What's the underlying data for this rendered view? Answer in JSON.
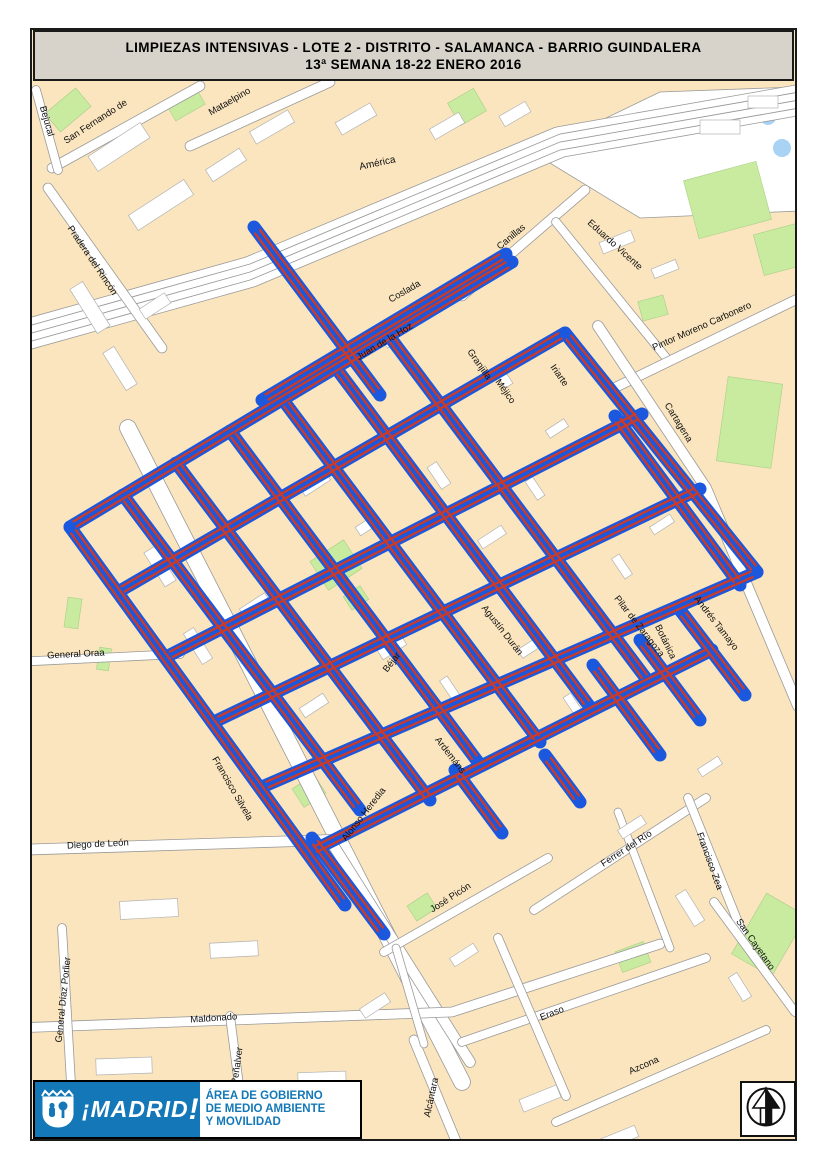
{
  "title": {
    "line1": "LIMPIEZAS  INTENSIVAS - LOTE 2 - DISTRITO - SALAMANCA - BARRIO GUINDALERA",
    "line2": "13ª SEMANA 18-22 ENERO 2016"
  },
  "footer": {
    "brand": "¡MADRID",
    "bang": "!",
    "dept1": "ÁREA DE GOBIERNO",
    "dept2": "DE MEDIO AMBIENTE",
    "dept3": "Y MOVILIDAD",
    "crest_icon": "madrid-bear-and-tree-crest",
    "north_icon": "north-arrow"
  },
  "colors": {
    "route_blue": "#1b58dd",
    "route_red": "#cc3a28",
    "block_peach": "#fae5be",
    "park_green": "#c8eba0",
    "water_blue": "#a9d3f5",
    "street_casing": "#9a9a9a",
    "street_fill": "#ffffff",
    "logo_blue": "#1478b8",
    "title_gray": "#d7d3cb"
  },
  "map": {
    "frame": {
      "x": 31,
      "y": 29,
      "w": 765,
      "h": 1111
    },
    "routes": [
      {
        "name": "coslada",
        "x1": 262,
        "y1": 400,
        "x2": 506,
        "y2": 254
      },
      {
        "name": "juan-de-la-hoz",
        "x1": 70,
        "y1": 527,
        "x2": 512,
        "y2": 262
      },
      {
        "name": "row-2",
        "x1": 118,
        "y1": 592,
        "x2": 565,
        "y2": 333
      },
      {
        "name": "row-3",
        "x1": 166,
        "y1": 657,
        "x2": 642,
        "y2": 414
      },
      {
        "name": "row-4",
        "x1": 214,
        "y1": 722,
        "x2": 700,
        "y2": 489
      },
      {
        "name": "agustin-duran",
        "x1": 262,
        "y1": 787,
        "x2": 757,
        "y2": 572
      },
      {
        "name": "ardemans-row",
        "x1": 310,
        "y1": 852,
        "x2": 712,
        "y2": 650
      },
      {
        "name": "arm-north",
        "x1": 254,
        "y1": 227,
        "x2": 380,
        "y2": 395
      },
      {
        "name": "francisco-silvela-route",
        "x1": 70,
        "y1": 527,
        "x2": 345,
        "y2": 905
      },
      {
        "name": "col-2",
        "x1": 123,
        "y1": 495,
        "x2": 360,
        "y2": 810
      },
      {
        "name": "col-3",
        "x1": 176,
        "y1": 463,
        "x2": 430,
        "y2": 800
      },
      {
        "name": "col-4",
        "x1": 230,
        "y1": 431,
        "x2": 478,
        "y2": 762
      },
      {
        "name": "col-5",
        "x1": 283,
        "y1": 400,
        "x2": 540,
        "y2": 742
      },
      {
        "name": "col-6",
        "x1": 336,
        "y1": 368,
        "x2": 590,
        "y2": 707
      },
      {
        "name": "col-7",
        "x1": 389,
        "y1": 336,
        "x2": 648,
        "y2": 681
      },
      {
        "name": "iriarte-route",
        "x1": 565,
        "y1": 333,
        "x2": 757,
        "y2": 572
      },
      {
        "name": "col-9",
        "x1": 615,
        "y1": 416,
        "x2": 740,
        "y2": 585
      },
      {
        "name": "alonso-heredia-stub",
        "x1": 312,
        "y1": 838,
        "x2": 384,
        "y2": 934
      },
      {
        "name": "stub-south-1",
        "x1": 455,
        "y1": 770,
        "x2": 502,
        "y2": 833
      },
      {
        "name": "stub-south-2",
        "x1": 545,
        "y1": 755,
        "x2": 580,
        "y2": 802
      },
      {
        "name": "pilar-de-zaragoza-stub",
        "x1": 593,
        "y1": 665,
        "x2": 660,
        "y2": 755
      },
      {
        "name": "botanica-stub",
        "x1": 640,
        "y1": 640,
        "x2": 700,
        "y2": 720
      },
      {
        "name": "andres-tamayo-stub",
        "x1": 680,
        "y1": 610,
        "x2": 745,
        "y2": 695
      }
    ],
    "streets": [
      {
        "name": "america",
        "w": 30,
        "pts": [
          [
            14,
            338
          ],
          [
            250,
            272
          ],
          [
            560,
            142
          ],
          [
            822,
            96
          ]
        ]
      },
      {
        "name": "america-lane-a",
        "thin": true,
        "pts": [
          [
            14,
            346
          ],
          [
            250,
            280
          ],
          [
            560,
            150
          ],
          [
            822,
            104
          ]
        ]
      },
      {
        "name": "america-lane-b",
        "thin": true,
        "pts": [
          [
            14,
            330
          ],
          [
            250,
            264
          ],
          [
            560,
            134
          ],
          [
            822,
            88
          ]
        ]
      },
      {
        "name": "america-lane-c",
        "thin": true,
        "pts": [
          [
            14,
            338
          ],
          [
            250,
            272
          ],
          [
            560,
            142
          ],
          [
            822,
            96
          ]
        ]
      },
      {
        "name": "san-fernando",
        "w": 9,
        "pts": [
          [
            52,
            168
          ],
          [
            200,
            86
          ]
        ]
      },
      {
        "name": "mataelpino",
        "w": 9,
        "pts": [
          [
            190,
            146
          ],
          [
            330,
            82
          ]
        ]
      },
      {
        "name": "bejucal",
        "w": 8,
        "pts": [
          [
            36,
            90
          ],
          [
            58,
            170
          ]
        ]
      },
      {
        "name": "pradera-del-rincon",
        "w": 9,
        "pts": [
          [
            48,
            188
          ],
          [
            162,
            348
          ]
        ]
      },
      {
        "name": "canillas",
        "w": 9,
        "pts": [
          [
            462,
            296
          ],
          [
            585,
            190
          ]
        ]
      },
      {
        "name": "eduardo-vicente",
        "w": 8,
        "pts": [
          [
            556,
            222
          ],
          [
            668,
            360
          ]
        ]
      },
      {
        "name": "pintor-moreno-carbonero",
        "w": 9,
        "pts": [
          [
            610,
            390
          ],
          [
            820,
            288
          ]
        ]
      },
      {
        "name": "cartagena",
        "w": 10,
        "pts": [
          [
            598,
            326
          ],
          [
            706,
            488
          ],
          [
            798,
            706
          ]
        ]
      },
      {
        "name": "francisco-silvela",
        "w": 16,
        "pts": [
          [
            128,
            428
          ],
          [
            462,
            1082
          ]
        ]
      },
      {
        "name": "diego-de-leon",
        "w": 10,
        "pts": [
          [
            14,
            850
          ],
          [
            330,
            840
          ],
          [
            470,
            1062
          ]
        ]
      },
      {
        "name": "general-oraa",
        "w": 8,
        "pts": [
          [
            14,
            662
          ],
          [
            180,
            654
          ]
        ]
      },
      {
        "name": "maldonado",
        "w": 9,
        "pts": [
          [
            14,
            1028
          ],
          [
            452,
            1012
          ],
          [
            660,
            944
          ]
        ]
      },
      {
        "name": "general-diaz-porlier",
        "w": 8,
        "pts": [
          [
            62,
            928
          ],
          [
            76,
            1170
          ]
        ]
      },
      {
        "name": "penalver",
        "w": 8,
        "pts": [
          [
            230,
            1016
          ],
          [
            250,
            1170
          ]
        ]
      },
      {
        "name": "alcantara",
        "w": 9,
        "pts": [
          [
            414,
            1040
          ],
          [
            468,
            1170
          ]
        ]
      },
      {
        "name": "jose-picon",
        "w": 8,
        "pts": [
          [
            384,
            952
          ],
          [
            548,
            858
          ]
        ]
      },
      {
        "name": "ferrer-del-rio",
        "w": 8,
        "pts": [
          [
            534,
            910
          ],
          [
            706,
            798
          ]
        ]
      },
      {
        "name": "francisco-zea",
        "w": 8,
        "pts": [
          [
            688,
            798
          ],
          [
            742,
            932
          ]
        ]
      },
      {
        "name": "san-cayetano",
        "w": 8,
        "pts": [
          [
            714,
            902
          ],
          [
            795,
            1012
          ]
        ]
      },
      {
        "name": "eraso",
        "w": 8,
        "pts": [
          [
            462,
            1042
          ],
          [
            706,
            958
          ]
        ]
      },
      {
        "name": "azcona",
        "w": 8,
        "pts": [
          [
            556,
            1122
          ],
          [
            766,
            1030
          ]
        ]
      },
      {
        "name": "side-street-1",
        "w": 8,
        "pts": [
          [
            498,
            938
          ],
          [
            566,
            1096
          ]
        ]
      },
      {
        "name": "side-street-2",
        "w": 7,
        "pts": [
          [
            618,
            812
          ],
          [
            670,
            948
          ]
        ]
      },
      {
        "name": "side-street-3",
        "w": 7,
        "pts": [
          [
            396,
            948
          ],
          [
            424,
            1044
          ]
        ]
      }
    ],
    "labels": [
      {
        "t": "América",
        "x": 378,
        "y": 166,
        "r": -12,
        "f": 10
      },
      {
        "t": "San Fernando de",
        "x": 97,
        "y": 124,
        "r": -33
      },
      {
        "t": "Mataelpino",
        "x": 231,
        "y": 104,
        "r": -30
      },
      {
        "t": "Bejucal",
        "x": 44,
        "y": 122,
        "r": 74
      },
      {
        "t": "Pradera del Rincón",
        "x": 90,
        "y": 262,
        "r": 56
      },
      {
        "t": "Canillas",
        "x": 513,
        "y": 239,
        "r": -40
      },
      {
        "t": "Eduardo Vicente",
        "x": 613,
        "y": 247,
        "r": 42
      },
      {
        "t": "Pintor Moreno Carbonero",
        "x": 703,
        "y": 329,
        "r": -24
      },
      {
        "t": "Cartagena",
        "x": 676,
        "y": 424,
        "r": 58
      },
      {
        "t": "Coslada",
        "x": 406,
        "y": 294,
        "r": -30
      },
      {
        "t": "Juan de la Hoz",
        "x": 386,
        "y": 344,
        "r": -31
      },
      {
        "t": "Granjilla",
        "x": 477,
        "y": 366,
        "r": 55
      },
      {
        "t": "Méjico",
        "x": 503,
        "y": 393,
        "r": 55
      },
      {
        "t": "Iriarte",
        "x": 557,
        "y": 377,
        "r": 55
      },
      {
        "t": "Agustín Durán",
        "x": 500,
        "y": 632,
        "r": 52
      },
      {
        "t": "Béjar",
        "x": 394,
        "y": 664,
        "r": -52
      },
      {
        "t": "Ardemáns",
        "x": 448,
        "y": 757,
        "r": 52
      },
      {
        "t": "Alonso Heredia",
        "x": 366,
        "y": 816,
        "r": -52
      },
      {
        "t": "Pilar de Zaragoza",
        "x": 637,
        "y": 628,
        "r": 52
      },
      {
        "t": "Botánica",
        "x": 663,
        "y": 643,
        "r": 64
      },
      {
        "t": "Andrés Tamayo",
        "x": 714,
        "y": 625,
        "r": 52
      },
      {
        "t": "Francisco Silvela",
        "x": 230,
        "y": 790,
        "r": 60
      },
      {
        "t": "General Oraa",
        "x": 76,
        "y": 657,
        "r": -3
      },
      {
        "t": "Diego de León",
        "x": 98,
        "y": 847,
        "r": -3
      },
      {
        "t": "Maldonado",
        "x": 214,
        "y": 1021,
        "r": -4
      },
      {
        "t": "General Díaz Porlier",
        "x": 66,
        "y": 1000,
        "r": -84
      },
      {
        "t": "Peñalver",
        "x": 240,
        "y": 1066,
        "r": -82
      },
      {
        "t": "Alcántara",
        "x": 434,
        "y": 1098,
        "r": -78
      },
      {
        "t": "José Picón",
        "x": 452,
        "y": 900,
        "r": -33
      },
      {
        "t": "Ferrer del Río",
        "x": 628,
        "y": 851,
        "r": -33
      },
      {
        "t": "Francisco Zea",
        "x": 707,
        "y": 862,
        "r": 70
      },
      {
        "t": "San Cayetano",
        "x": 753,
        "y": 946,
        "r": 55
      },
      {
        "t": "Eraso",
        "x": 553,
        "y": 1016,
        "r": -22
      },
      {
        "t": "Azcona",
        "x": 645,
        "y": 1068,
        "r": -24
      }
    ],
    "greens": [
      {
        "x": 690,
        "y": 170,
        "w": 75,
        "h": 60,
        "r": -15
      },
      {
        "x": 758,
        "y": 228,
        "w": 48,
        "h": 42,
        "r": -15
      },
      {
        "x": 722,
        "y": 380,
        "w": 55,
        "h": 85,
        "r": 8
      },
      {
        "x": 795,
        "y": 295,
        "w": 26,
        "h": 65,
        "r": 0
      },
      {
        "x": 640,
        "y": 298,
        "w": 26,
        "h": 20,
        "r": -15
      },
      {
        "x": 56,
        "y": 90,
        "w": 24,
        "h": 40,
        "r": 50
      },
      {
        "x": 168,
        "y": 92,
        "w": 34,
        "h": 22,
        "r": -30
      },
      {
        "x": 452,
        "y": 94,
        "w": 30,
        "h": 26,
        "r": -30
      },
      {
        "x": 316,
        "y": 548,
        "w": 40,
        "h": 34,
        "r": -33
      },
      {
        "x": 296,
        "y": 780,
        "w": 26,
        "h": 22,
        "r": -33
      },
      {
        "x": 746,
        "y": 900,
        "w": 46,
        "h": 70,
        "r": 30
      },
      {
        "x": 754,
        "y": 1082,
        "w": 48,
        "h": 36,
        "r": 0
      },
      {
        "x": 618,
        "y": 946,
        "w": 30,
        "h": 22,
        "r": -20
      },
      {
        "x": 66,
        "y": 598,
        "w": 14,
        "h": 30,
        "r": 8
      },
      {
        "x": 98,
        "y": 648,
        "w": 12,
        "h": 22,
        "r": 8
      },
      {
        "x": 346,
        "y": 590,
        "w": 20,
        "h": 16,
        "r": -33
      },
      {
        "x": 410,
        "y": 898,
        "w": 24,
        "h": 18,
        "r": -33
      }
    ],
    "water": [
      {
        "cx": 768,
        "cy": 117,
        "rr": 8
      },
      {
        "cx": 782,
        "cy": 148,
        "rr": 9
      }
    ],
    "buildings": [
      [
        88,
        138,
        62,
        18,
        -33
      ],
      [
        128,
        196,
        66,
        18,
        -33
      ],
      [
        206,
        158,
        40,
        14,
        -33
      ],
      [
        250,
        120,
        44,
        14,
        -30
      ],
      [
        336,
        112,
        40,
        14,
        -30
      ],
      [
        64,
        300,
        52,
        15,
        58
      ],
      [
        98,
        362,
        44,
        13,
        58
      ],
      [
        140,
        300,
        30,
        12,
        -33
      ],
      [
        430,
        120,
        34,
        12,
        -30
      ],
      [
        500,
        108,
        30,
        12,
        -30
      ],
      [
        600,
        236,
        34,
        12,
        -22
      ],
      [
        652,
        264,
        26,
        10,
        -22
      ],
      [
        700,
        120,
        40,
        14,
        0
      ],
      [
        748,
        96,
        30,
        12,
        0
      ],
      [
        300,
        478,
        30,
        11,
        -33
      ],
      [
        356,
        520,
        24,
        10,
        -33
      ],
      [
        426,
        470,
        26,
        11,
        56
      ],
      [
        478,
        532,
        28,
        10,
        -33
      ],
      [
        524,
        484,
        22,
        9,
        56
      ],
      [
        374,
        332,
        22,
        9,
        56
      ],
      [
        428,
        298,
        26,
        10,
        -33
      ],
      [
        492,
        372,
        22,
        9,
        56
      ],
      [
        546,
        424,
        22,
        9,
        -33
      ],
      [
        300,
        700,
        28,
        11,
        -33
      ],
      [
        378,
        642,
        28,
        11,
        -33
      ],
      [
        438,
        684,
        24,
        9,
        56
      ],
      [
        518,
        642,
        26,
        10,
        -33
      ],
      [
        562,
        700,
        22,
        9,
        56
      ],
      [
        610,
        562,
        24,
        9,
        56
      ],
      [
        650,
        520,
        24,
        9,
        -33
      ],
      [
        140,
        560,
        40,
        13,
        58
      ],
      [
        180,
        640,
        36,
        12,
        58
      ],
      [
        240,
        600,
        30,
        11,
        -33
      ],
      [
        120,
        900,
        58,
        18,
        -3
      ],
      [
        210,
        942,
        48,
        15,
        -3
      ],
      [
        96,
        1058,
        56,
        16,
        -2
      ],
      [
        176,
        1108,
        40,
        13,
        -2
      ],
      [
        298,
        1072,
        48,
        15,
        -2
      ],
      [
        520,
        1092,
        40,
        13,
        -22
      ],
      [
        600,
        1132,
        38,
        12,
        -22
      ],
      [
        672,
        902,
        36,
        12,
        58
      ],
      [
        726,
        982,
        28,
        10,
        58
      ],
      [
        618,
        822,
        28,
        10,
        -33
      ],
      [
        698,
        762,
        24,
        9,
        -33
      ],
      [
        360,
        1000,
        30,
        11,
        -33
      ],
      [
        450,
        950,
        28,
        10,
        -33
      ]
    ]
  }
}
